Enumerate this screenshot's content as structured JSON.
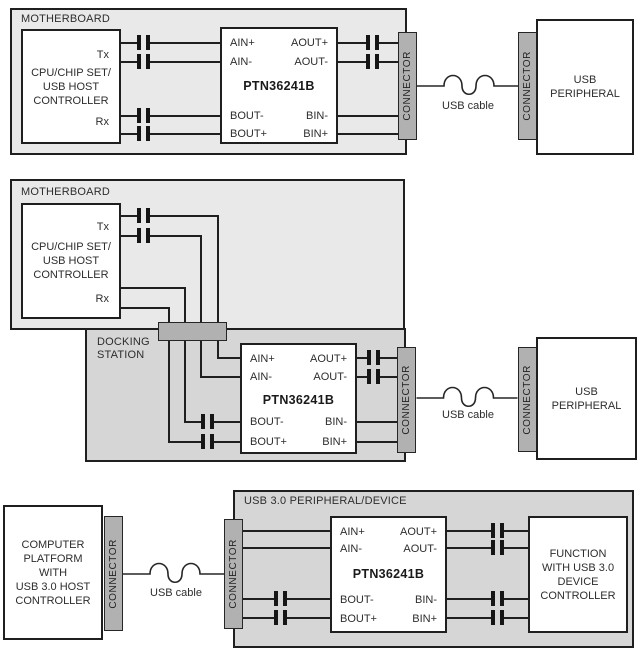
{
  "colors": {
    "board-fill": "#e9e9e9",
    "dock-fill": "#d6d6d6",
    "connector-fill": "#b1b1b1",
    "box-fill": "#ffffff",
    "line-color": "#1f1f1f",
    "text-color": "#2d2d2d"
  },
  "shared": {
    "connector_label": "CONNECTOR",
    "usb_cable_label": "USB cable",
    "chip_name": "PTN36241B",
    "tx_label": "Tx",
    "rx_label": "Rx",
    "pins": {
      "ain_plus": "AIN+",
      "ain_minus": "AIN-",
      "aout_plus": "AOUT+",
      "aout_minus": "AOUT-",
      "bout_minus": "BOUT-",
      "bout_plus": "BOUT+",
      "bin_minus": "BIN-",
      "bin_plus": "BIN+"
    }
  },
  "d1": {
    "board_label": "MOTHERBOARD",
    "host_label": "CPU/CHIP SET/\nUSB HOST\nCONTROLLER",
    "peripheral_label": "USB\nPERIPHERAL"
  },
  "d2": {
    "board_label": "MOTHERBOARD",
    "host_label": "CPU/CHIP SET/\nUSB HOST\nCONTROLLER",
    "docking_label": "DOCKING\nSTATION",
    "peripheral_label": "USB\nPERIPHERAL"
  },
  "d3": {
    "board_label": "USB 3.0 PERIPHERAL/DEVICE",
    "host_label": "COMPUTER\nPLATFORM\nWITH\nUSB 3.0 HOST\nCONTROLLER",
    "function_label": "FUNCTION\nWITH USB 3.0\nDEVICE\nCONTROLLER"
  }
}
